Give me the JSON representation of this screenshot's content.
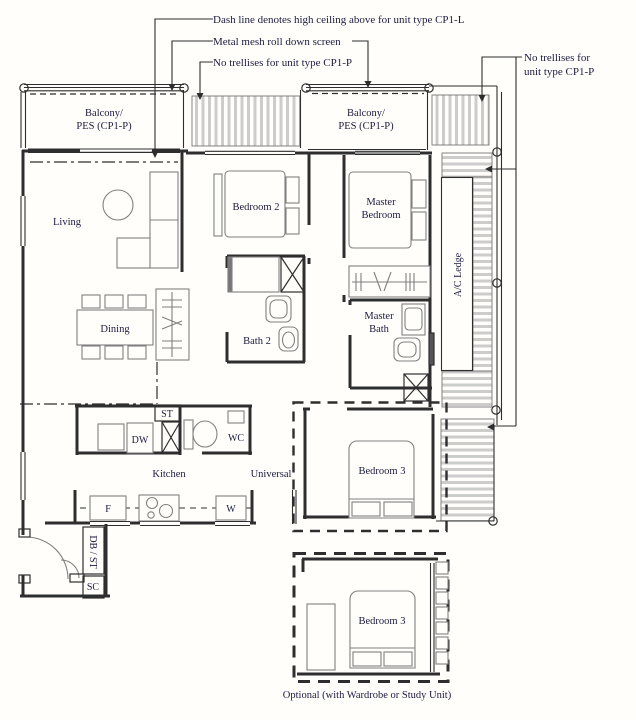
{
  "colors": {
    "line": "#2e2e2e",
    "text": "#1b1b3d",
    "trellis_bar": "#cccccb",
    "furniture": "#808080",
    "background": "#fffefb"
  },
  "annotations": {
    "high_ceiling": "Dash line denotes high ceiling above for unit type CP1-L",
    "metal_mesh": "Metal mesh roll down screen",
    "no_trellises_left": "No trellises for unit type CP1-P",
    "no_trellises_right_l1": "No trellises for",
    "no_trellises_right_l2": "unit type CP1-P"
  },
  "rooms": {
    "balcony_left_l1": "Balcony/",
    "balcony_left_l2": "PES (CP1-P)",
    "balcony_right_l1": "Balcony/",
    "balcony_right_l2": "PES (CP1-P)",
    "living": "Living",
    "dining": "Dining",
    "bedroom2": "Bedroom 2",
    "master_l1": "Master",
    "master_l2": "Bedroom",
    "bath2": "Bath 2",
    "master_bath_l1": "Master",
    "master_bath_l2": "Bath",
    "ac_ledge": "A/C Ledge",
    "kitchen": "Kitchen",
    "universal": "Universal",
    "wc": "WC",
    "bedroom3": "Bedroom 3",
    "bedroom3_optional": "Bedroom 3"
  },
  "fixtures": {
    "store": "ST",
    "dishwasher": "DW",
    "fridge": "F",
    "washer": "W",
    "db_store": "DB / ST",
    "shoe_cabinet": "SC"
  },
  "caption": {
    "optional": "Optional (with Wardrobe or Study Unit)"
  }
}
